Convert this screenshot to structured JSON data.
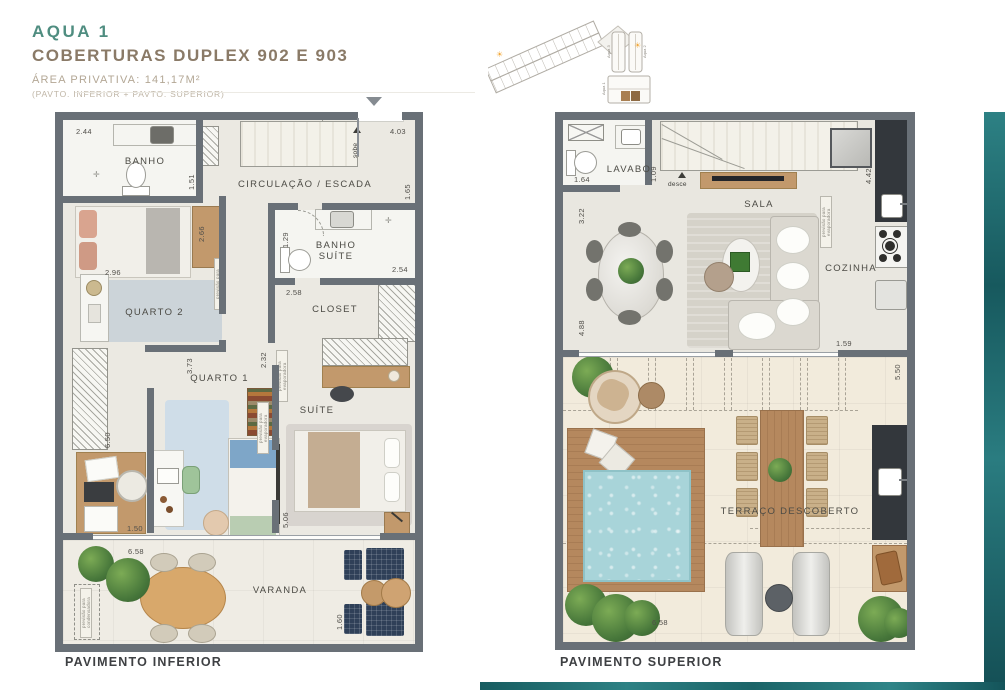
{
  "header": {
    "project": "AQUA 1",
    "title": "COBERTURAS DUPLEX 902 E 903",
    "area": "ÁREA PRIVATIVA: 141,17M²",
    "subtitle": "(PAVTO. INFERIOR + PAVTO. SUPERIOR)"
  },
  "colors": {
    "accent_teal": "#2a7d7d",
    "header_teal": "#4f8d80",
    "header_brown": "#8a7a67",
    "wall_gray": "#697077",
    "pool_blue": "#a8d4d9"
  },
  "site_plan": {
    "tower_left_label": "Aqua 3",
    "tower_right_label": "Aqua 2",
    "block_label": "Aqua 1",
    "sun_icon": "☀"
  },
  "inferior": {
    "title": "PAVIMENTO INFERIOR",
    "rooms": {
      "banho": "BANHO",
      "circulacao": "CIRCULAÇÃO / ESCADA",
      "banho_suite": "BANHO SUÍTE",
      "quarto2": "QUARTO 2",
      "closet": "CLOSET",
      "quarto1": "QUARTO 1",
      "suite": "SUÍTE",
      "varanda": "VARANDA"
    },
    "dims": {
      "banho_width": "2.44",
      "banho_depth": "1.51",
      "hall_width": "4.03",
      "hall_depth": "1.65",
      "dresser": "2.66",
      "quarto2_width": "2.96",
      "banho_suite_width": "1.29",
      "banho_suite_depth": "2.54",
      "closet_width": "2.58",
      "closet_left": "2.32",
      "quarto1_depth": "3.73",
      "left_strip": "6.50",
      "quarto1_width": "1.50",
      "suite_depth": "5.06",
      "varanda_width": "6.58",
      "varanda_depth": "1.60"
    },
    "notes": {
      "sobe": "sobe",
      "evaporadora": "previsão para evaporadora",
      "condensadora": "previsão para condensadora"
    }
  },
  "superior": {
    "title": "PAVIMENTO SUPERIOR",
    "rooms": {
      "lavabo": "LAVABO",
      "sala": "SALA",
      "cozinha": "COZINHA",
      "terraco": "TERRAÇO DESCOBERTO"
    },
    "dims": {
      "lavabo_width": "1.64",
      "lavabo_depth": "1.09",
      "sala_left_upper": "3.22",
      "cozinha_depth": "4.42",
      "sala_left_lower": "4.88",
      "sala_right": "1.59",
      "terraco_depth": "5.50",
      "terraco_width": "6.58"
    },
    "notes": {
      "desce": "desce",
      "evaporadora": "previsão para evaporadora"
    }
  }
}
